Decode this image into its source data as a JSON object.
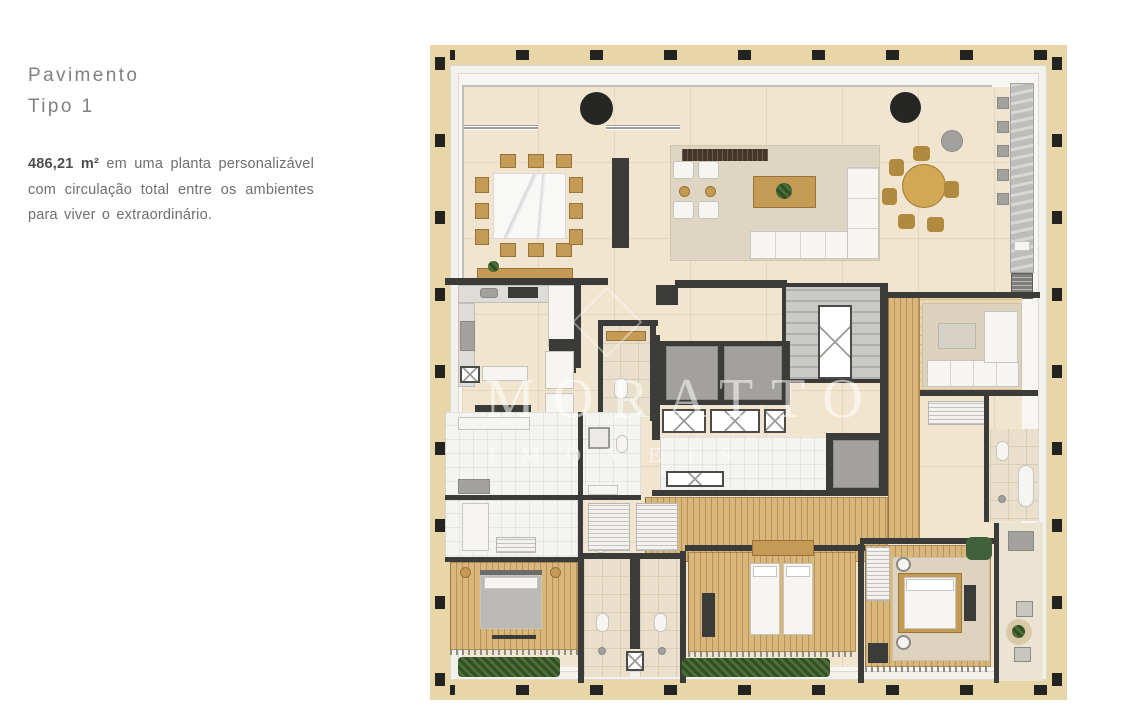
{
  "intro": {
    "title_line1": "Pavimento",
    "title_line2": "Tipo 1",
    "area_bold": "486,21 m²",
    "description_rest": " em uma planta personalizável com circulação total entre os ambientes para viver o extraordinário."
  },
  "floor_plan": {
    "watermark_line1": "MORATTO",
    "watermark_line2": "IMÓVEIS",
    "palette": {
      "frame_tan": "#e9d6a8",
      "column_black": "#232321",
      "slab_white": "#f7f6f2",
      "floor_beige": "#f1e5d0",
      "wall_dark": "#3b3b39",
      "deck_wood": "#d9b679",
      "furniture_wood": "#c49a54",
      "marble_gray": "#bdbdbb",
      "plant_green": "#4d6e3a"
    }
  }
}
